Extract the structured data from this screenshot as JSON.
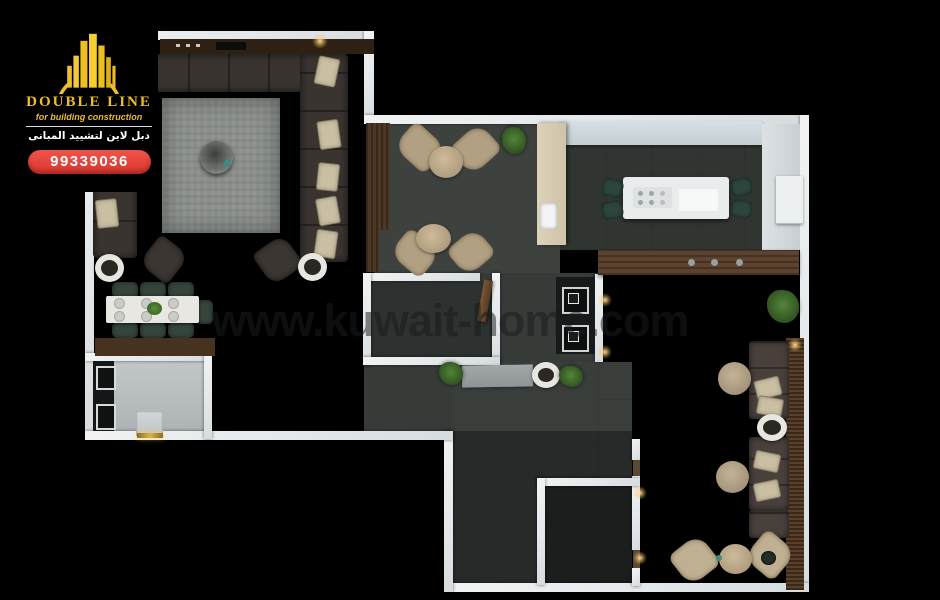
{
  "branding": {
    "company_name": "DOUBLE LINE",
    "tagline": "for building construction",
    "company_name_arabic": "دبل لاين لتشييد المبانى",
    "phone_number": "99339036",
    "colors": {
      "gold": "#EDBD2A",
      "badge_red": "#E5403A"
    }
  },
  "watermark": {
    "text": "www.kuwait-home.com",
    "color": "rgba(24,27,29,0.52)"
  },
  "scene": {
    "type": "3d-floor-plan-top-view",
    "background": "#000000",
    "wall_color": "#E9ECEE",
    "floor_dark": "#3B3F3C",
    "floor_light": "#B7BCBE",
    "wood": "#5D432F"
  }
}
